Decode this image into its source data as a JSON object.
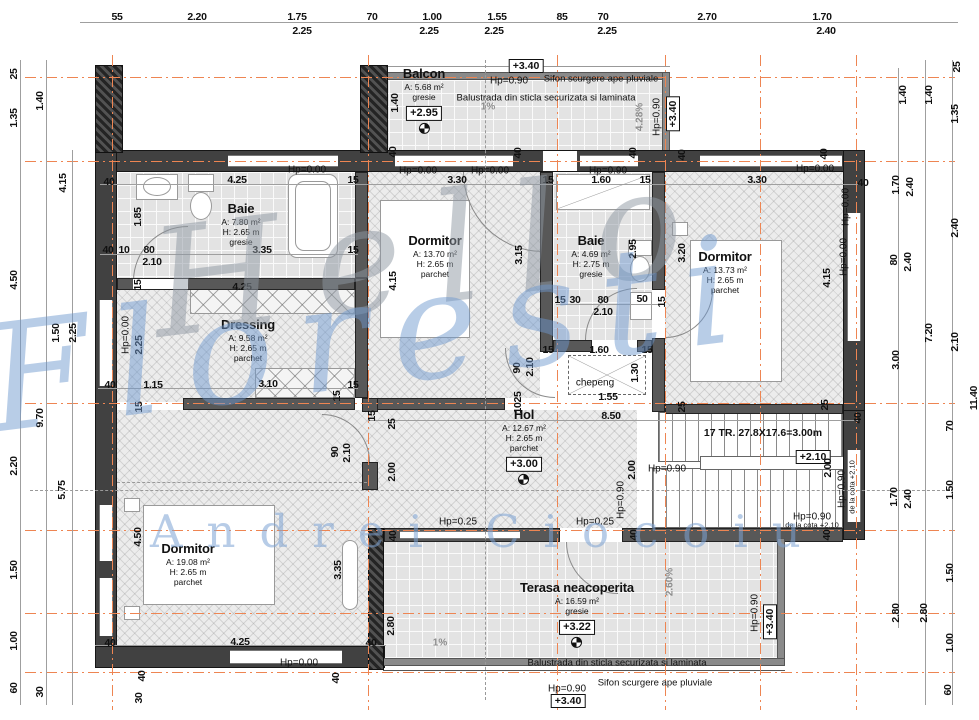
{
  "drawing": {
    "watermark": {
      "line1": "Hello",
      "line2": "Floresti",
      "line3": "Andrei Ciocoiu"
    },
    "colors": {
      "axis": "#ee8552",
      "wall": "#414141",
      "watermark_gray": "#8f98a3",
      "watermark_blue": "#7da3d4"
    },
    "rooms": [
      {
        "name": "Balcon",
        "lines": [
          "A: 5.68 m²",
          "gresie"
        ],
        "badge": "+2.95",
        "x": 424,
        "y": 100
      },
      {
        "name": "Baie",
        "lines": [
          "A: 7.80 m²",
          "H: 2.65 m",
          "gresie"
        ],
        "x": 241,
        "y": 224
      },
      {
        "name": "Dormitor",
        "lines": [
          "A: 13.70 m²",
          "H: 2.65 m",
          "parchet"
        ],
        "x": 435,
        "y": 256
      },
      {
        "name": "Baie",
        "lines": [
          "A: 4.69 m²",
          "H: 2.75 m",
          "gresie"
        ],
        "x": 591,
        "y": 256
      },
      {
        "name": "Dormitor",
        "lines": [
          "A: 13.73 m²",
          "H: 2.65 m",
          "parchet"
        ],
        "x": 725,
        "y": 272
      },
      {
        "name": "Dressing",
        "lines": [
          "A: 9.58 m²",
          "H: 2.65 m",
          "parchet"
        ],
        "x": 248,
        "y": 340
      },
      {
        "name": "Hol",
        "lines": [
          "A: 12.67 m²",
          "H: 2.65 m",
          "parchet"
        ],
        "badge": "+3.00",
        "x": 524,
        "y": 446
      },
      {
        "name": "Dormitor",
        "lines": [
          "A: 19.08 m²",
          "H: 2.65 m",
          "parchet"
        ],
        "x": 188,
        "y": 564
      },
      {
        "name": "Terasa neacoperita",
        "lines": [
          "A: 16.59 m²",
          "gresie"
        ],
        "badge": "+3.22",
        "x": 577,
        "y": 614
      }
    ],
    "labels": [
      {
        "t": "55",
        "x": 117,
        "y": 17
      },
      {
        "t": "2.20",
        "x": 197,
        "y": 17
      },
      {
        "t": "1.75",
        "x": 297,
        "y": 17
      },
      {
        "t": "2.25",
        "x": 302,
        "y": 31
      },
      {
        "t": "70",
        "x": 372,
        "y": 17
      },
      {
        "t": "1.00",
        "x": 432,
        "y": 17
      },
      {
        "t": "2.25",
        "x": 429,
        "y": 31
      },
      {
        "t": "1.55",
        "x": 497,
        "y": 17
      },
      {
        "t": "2.25",
        "x": 494,
        "y": 31
      },
      {
        "t": "85",
        "x": 562,
        "y": 17
      },
      {
        "t": "70",
        "x": 603,
        "y": 17
      },
      {
        "t": "2.25",
        "x": 607,
        "y": 31
      },
      {
        "t": "2.70",
        "x": 707,
        "y": 17
      },
      {
        "t": "1.70",
        "x": 822,
        "y": 17
      },
      {
        "t": "2.40",
        "x": 826,
        "y": 31
      },
      {
        "t": "25",
        "x": 14,
        "y": 74,
        "r": 1
      },
      {
        "t": "1.40",
        "x": 40,
        "y": 101,
        "r": 1
      },
      {
        "t": "1.35",
        "x": 14,
        "y": 118,
        "r": 1
      },
      {
        "t": "4.15",
        "x": 63,
        "y": 183,
        "r": 1
      },
      {
        "t": "4.50",
        "x": 14,
        "y": 280,
        "r": 1
      },
      {
        "t": "1.50",
        "x": 56,
        "y": 333,
        "r": 1
      },
      {
        "t": "2.25",
        "x": 73,
        "y": 333,
        "r": 1
      },
      {
        "t": "9.70",
        "x": 40,
        "y": 418,
        "r": 1
      },
      {
        "t": "2.20",
        "x": 14,
        "y": 466,
        "r": 1
      },
      {
        "t": "5.75",
        "x": 62,
        "y": 490,
        "r": 1
      },
      {
        "t": "1.50",
        "x": 14,
        "y": 570,
        "r": 1
      },
      {
        "t": "1.00",
        "x": 14,
        "y": 641,
        "r": 1
      },
      {
        "t": "60",
        "x": 14,
        "y": 688,
        "r": 1
      },
      {
        "t": "30",
        "x": 40,
        "y": 692,
        "r": 1
      },
      {
        "t": "25",
        "x": 957,
        "y": 67,
        "r": 1
      },
      {
        "t": "1.40",
        "x": 903,
        "y": 95,
        "r": 1
      },
      {
        "t": "1.40",
        "x": 929,
        "y": 95,
        "r": 1
      },
      {
        "t": "1.35",
        "x": 955,
        "y": 114,
        "r": 1
      },
      {
        "t": "1.70",
        "x": 896,
        "y": 185,
        "r": 1
      },
      {
        "t": "2.40",
        "x": 910,
        "y": 187,
        "r": 1
      },
      {
        "t": "2.40",
        "x": 955,
        "y": 228,
        "r": 1
      },
      {
        "t": "80",
        "x": 894,
        "y": 260,
        "r": 1
      },
      {
        "t": "2.40",
        "x": 908,
        "y": 262,
        "r": 1
      },
      {
        "t": "7.20",
        "x": 929,
        "y": 333,
        "r": 1
      },
      {
        "t": "2.10",
        "x": 955,
        "y": 342,
        "r": 1
      },
      {
        "t": "3.00",
        "x": 896,
        "y": 360,
        "r": 1
      },
      {
        "t": "11.40",
        "x": 974,
        "y": 398,
        "r": 1
      },
      {
        "t": "70",
        "x": 950,
        "y": 426,
        "r": 1
      },
      {
        "t": "1.70",
        "x": 894,
        "y": 497,
        "r": 1
      },
      {
        "t": "2.40",
        "x": 908,
        "y": 499,
        "r": 1
      },
      {
        "t": "1.50",
        "x": 950,
        "y": 490,
        "r": 1
      },
      {
        "t": "1.50",
        "x": 950,
        "y": 573,
        "r": 1
      },
      {
        "t": "2.80",
        "x": 896,
        "y": 613,
        "r": 1
      },
      {
        "t": "2.80",
        "x": 924,
        "y": 613,
        "r": 1
      },
      {
        "t": "1.00",
        "x": 950,
        "y": 643,
        "r": 1
      },
      {
        "t": "60",
        "x": 948,
        "y": 690,
        "r": 1
      },
      {
        "t": "+3.40",
        "x": 526,
        "y": 66,
        "k": "boxed"
      },
      {
        "t": "Hp=0.90",
        "x": 509,
        "y": 81,
        "k": "hp"
      },
      {
        "t": "Sifon scurgere ape pluviale",
        "x": 601,
        "y": 79,
        "k": "anno"
      },
      {
        "t": "1.40",
        "x": 395,
        "y": 103,
        "r": 1
      },
      {
        "t": "Balustrada din sticla securizata si laminata",
        "x": 546,
        "y": 98,
        "k": "anno"
      },
      {
        "t": "1%",
        "x": 488,
        "y": 107,
        "k": "pct"
      },
      {
        "t": "4.28%",
        "x": 640,
        "y": 117,
        "r": 1,
        "k": "pct"
      },
      {
        "t": "Hp=0.90",
        "x": 657,
        "y": 117,
        "r": 1,
        "k": "hp"
      },
      {
        "t": "+3.40",
        "x": 673,
        "y": 114,
        "r": 1,
        "k": "boxed"
      },
      {
        "t": "40",
        "x": 393,
        "y": 152,
        "r": 1
      },
      {
        "t": "40",
        "x": 518,
        "y": 153,
        "r": 1
      },
      {
        "t": "40",
        "x": 633,
        "y": 153,
        "r": 1
      },
      {
        "t": "40",
        "x": 682,
        "y": 155,
        "r": 1
      },
      {
        "t": "40",
        "x": 824,
        "y": 154,
        "r": 1
      },
      {
        "t": "Hp=0.00",
        "x": 307,
        "y": 170,
        "k": "hp"
      },
      {
        "t": "Hp=0.00",
        "x": 418,
        "y": 171,
        "k": "hp"
      },
      {
        "t": "Hp=0.00",
        "x": 490,
        "y": 171,
        "k": "hp"
      },
      {
        "t": "Hp=0.90",
        "x": 608,
        "y": 171,
        "k": "hp"
      },
      {
        "t": "Hp=0.00",
        "x": 815,
        "y": 169,
        "k": "hp"
      },
      {
        "t": "40",
        "x": 109,
        "y": 182
      },
      {
        "t": "4.25",
        "x": 237,
        "y": 180
      },
      {
        "t": "15",
        "x": 353,
        "y": 180
      },
      {
        "t": "3.30",
        "x": 457,
        "y": 180
      },
      {
        "t": "15",
        "x": 548,
        "y": 180
      },
      {
        "t": "1.60",
        "x": 601,
        "y": 180
      },
      {
        "t": "15",
        "x": 645,
        "y": 180
      },
      {
        "t": "3.30",
        "x": 757,
        "y": 180
      },
      {
        "t": "40",
        "x": 863,
        "y": 183
      },
      {
        "t": "1.85",
        "x": 138,
        "y": 217,
        "r": 1
      },
      {
        "t": "40",
        "x": 108,
        "y": 250
      },
      {
        "t": "10",
        "x": 124,
        "y": 250
      },
      {
        "t": "80",
        "x": 149,
        "y": 250
      },
      {
        "t": "2.10",
        "x": 152,
        "y": 262
      },
      {
        "t": "3.35",
        "x": 262,
        "y": 250
      },
      {
        "t": "15",
        "x": 353,
        "y": 250
      },
      {
        "t": "15",
        "x": 138,
        "y": 285,
        "r": 1
      },
      {
        "t": "4.25",
        "x": 242,
        "y": 287
      },
      {
        "t": "4.15",
        "x": 393,
        "y": 281,
        "r": 1
      },
      {
        "t": "3.15",
        "x": 519,
        "y": 255,
        "r": 1
      },
      {
        "t": "2.95",
        "x": 633,
        "y": 249,
        "r": 1
      },
      {
        "t": "15",
        "x": 560,
        "y": 300
      },
      {
        "t": "30",
        "x": 575,
        "y": 300
      },
      {
        "t": "80",
        "x": 603,
        "y": 300
      },
      {
        "t": "50",
        "x": 642,
        "y": 299
      },
      {
        "t": "2.10",
        "x": 603,
        "y": 312
      },
      {
        "t": "15",
        "x": 662,
        "y": 302,
        "r": 1
      },
      {
        "t": "3.20",
        "x": 682,
        "y": 253,
        "r": 1
      },
      {
        "t": "Hp=0.00",
        "x": 846,
        "y": 207,
        "r": 1,
        "k": "hp"
      },
      {
        "t": "Hp=0.00",
        "x": 844,
        "y": 257,
        "r": 1,
        "k": "hp"
      },
      {
        "t": "4.15",
        "x": 827,
        "y": 278,
        "r": 1
      },
      {
        "t": "Hp=0.00",
        "x": 126,
        "y": 335,
        "r": 1,
        "k": "hp"
      },
      {
        "t": "2.25",
        "x": 139,
        "y": 345,
        "r": 1
      },
      {
        "t": "40",
        "x": 110,
        "y": 385
      },
      {
        "t": "1.15",
        "x": 153,
        "y": 385
      },
      {
        "t": "3.10",
        "x": 268,
        "y": 384
      },
      {
        "t": "15",
        "x": 353,
        "y": 385
      },
      {
        "t": "15",
        "x": 139,
        "y": 407,
        "r": 1
      },
      {
        "t": "15",
        "x": 337,
        "y": 396,
        "r": 1
      },
      {
        "t": "15",
        "x": 372,
        "y": 416,
        "r": 1
      },
      {
        "t": "25",
        "x": 392,
        "y": 424,
        "r": 1
      },
      {
        "t": "15",
        "x": 548,
        "y": 350
      },
      {
        "t": "1.60",
        "x": 599,
        "y": 350
      },
      {
        "t": "15",
        "x": 647,
        "y": 350
      },
      {
        "t": "chepeng",
        "x": 595,
        "y": 383,
        "k": "hp"
      },
      {
        "t": "1.30",
        "x": 635,
        "y": 373,
        "r": 1
      },
      {
        "t": "90",
        "x": 517,
        "y": 368,
        "r": 1
      },
      {
        "t": "2.10",
        "x": 530,
        "y": 367,
        "r": 1
      },
      {
        "t": "25",
        "x": 518,
        "y": 397,
        "r": 1
      },
      {
        "t": "10",
        "x": 518,
        "y": 408,
        "r": 1
      },
      {
        "t": "1.55",
        "x": 608,
        "y": 397
      },
      {
        "t": "8.50",
        "x": 611,
        "y": 416
      },
      {
        "t": "90",
        "x": 335,
        "y": 452,
        "r": 1
      },
      {
        "t": "2.10",
        "x": 347,
        "y": 453,
        "r": 1
      },
      {
        "t": "2.00",
        "x": 392,
        "y": 472,
        "r": 1
      },
      {
        "t": "2.00",
        "x": 632,
        "y": 470,
        "r": 1
      },
      {
        "t": "Hp=0.90",
        "x": 621,
        "y": 500,
        "r": 1,
        "k": "hp"
      },
      {
        "t": "Hp=0.25",
        "x": 458,
        "y": 522,
        "k": "hp"
      },
      {
        "t": "Hp=0.25",
        "x": 595,
        "y": 522,
        "k": "hp"
      },
      {
        "t": "40",
        "x": 393,
        "y": 536,
        "r": 1
      },
      {
        "t": "40",
        "x": 634,
        "y": 535,
        "r": 1
      },
      {
        "t": "25",
        "x": 682,
        "y": 407,
        "r": 1
      },
      {
        "t": "25",
        "x": 825,
        "y": 405,
        "r": 1
      },
      {
        "t": "40",
        "x": 858,
        "y": 418,
        "r": 1
      },
      {
        "t": "17 TR. 27.8X17.6=3.00m",
        "x": 763,
        "y": 433,
        "k": "stairlbl"
      },
      {
        "t": "+2.10",
        "x": 813,
        "y": 457,
        "k": "boxed"
      },
      {
        "t": "Hp=0.90",
        "x": 667,
        "y": 469,
        "k": "hp"
      },
      {
        "t": "2.00",
        "x": 828,
        "y": 468,
        "r": 1
      },
      {
        "t": "Hp=0.90",
        "x": 842,
        "y": 489,
        "r": 1,
        "k": "hp"
      },
      {
        "t": "de la cota +2.10",
        "x": 852,
        "y": 487,
        "r": 1,
        "k": "tiny"
      },
      {
        "t": "Hp=0.90",
        "x": 812,
        "y": 517,
        "k": "hp"
      },
      {
        "t": "de la cota +2.10",
        "x": 812,
        "y": 525,
        "k": "tiny"
      },
      {
        "t": "40",
        "x": 827,
        "y": 535,
        "r": 1
      },
      {
        "t": "4.50",
        "x": 138,
        "y": 537,
        "r": 1
      },
      {
        "t": "3.35",
        "x": 338,
        "y": 570,
        "r": 1
      },
      {
        "t": "40",
        "x": 110,
        "y": 643
      },
      {
        "t": "4.25",
        "x": 240,
        "y": 642
      },
      {
        "t": "40",
        "x": 371,
        "y": 643
      },
      {
        "t": "Hp=0.00",
        "x": 299,
        "y": 663,
        "k": "hp"
      },
      {
        "t": "40",
        "x": 142,
        "y": 676,
        "r": 1
      },
      {
        "t": "40",
        "x": 336,
        "y": 678,
        "r": 1
      },
      {
        "t": "30",
        "x": 139,
        "y": 698,
        "r": 1
      },
      {
        "t": "2.80",
        "x": 391,
        "y": 626,
        "r": 1
      },
      {
        "t": "1%",
        "x": 440,
        "y": 643,
        "k": "pct"
      },
      {
        "t": "2.60%",
        "x": 670,
        "y": 582,
        "r": 1,
        "k": "pct"
      },
      {
        "t": "Hp=0.90",
        "x": 755,
        "y": 613,
        "r": 1,
        "k": "hp"
      },
      {
        "t": "+3.40",
        "x": 770,
        "y": 622,
        "r": 1,
        "k": "boxed"
      },
      {
        "t": "Balustrada din sticla securizata si laminata",
        "x": 617,
        "y": 663,
        "k": "anno"
      },
      {
        "t": "Sifon scurgere ape pluviale",
        "x": 655,
        "y": 683,
        "k": "anno"
      },
      {
        "t": "Hp=0.90",
        "x": 567,
        "y": 689,
        "k": "hp"
      },
      {
        "t": "+3.40",
        "x": 568,
        "y": 701,
        "k": "boxed"
      }
    ]
  }
}
